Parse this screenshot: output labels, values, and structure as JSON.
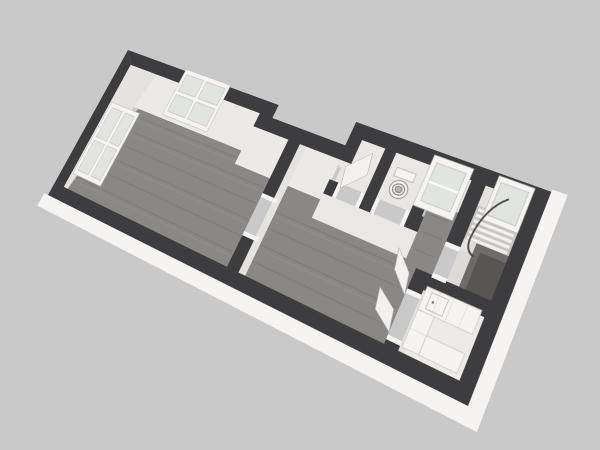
{
  "scene": {
    "type": "3d-floor-plan-render",
    "view": "tilted-perspective-top-down",
    "background_color": "#c9c9c9"
  },
  "colors": {
    "background": "#c9c9c9",
    "wall": "#3d3d3f",
    "wall_face": "#eceae7",
    "wall_face_west": "#e5e3e0",
    "wall_face_small": "#eae8e5",
    "wood_floor": "#8a8886",
    "light_floor": "#e8e7e4",
    "stairs_floor": "#dcdbd8",
    "kitchen_floor": "#edebe8",
    "slab": "#f5f4f2",
    "glass": "#e2e4e2",
    "fixture_white": "#f5f4f2",
    "leaf_white": "#f2f1ef",
    "tread_base": "#c7c6c4",
    "tread_bar": "#f2f1ef",
    "stairwell_outer": "#6e6c6a",
    "stairwell_inner": "#585654",
    "railing": "#4a4846"
  },
  "rooms": [
    {
      "name": "living-room",
      "floor": "wood"
    },
    {
      "name": "middle-room",
      "floor": "wood"
    },
    {
      "name": "hallway",
      "floor": "light"
    },
    {
      "name": "wc",
      "floor": "light"
    },
    {
      "name": "vestibule",
      "floor": "wood"
    },
    {
      "name": "stair-room",
      "floor": "light"
    },
    {
      "name": "kitchen",
      "floor": "light"
    }
  ],
  "fixtures": [
    {
      "name": "window-west",
      "panes": "2x2"
    },
    {
      "name": "window-north",
      "panes": "2x2"
    },
    {
      "name": "window-vestibule",
      "panes": "1x2"
    },
    {
      "name": "window-stairs",
      "panes": "1"
    },
    {
      "name": "toilet",
      "location": "wc"
    },
    {
      "name": "staircase-with-curved-railing",
      "location": "stair-room"
    },
    {
      "name": "u-shaped-counter",
      "location": "kitchen"
    },
    {
      "name": "double-door-leaves",
      "location": "kitchen-entry"
    },
    {
      "name": "door-leaf",
      "location": "hallway"
    }
  ]
}
